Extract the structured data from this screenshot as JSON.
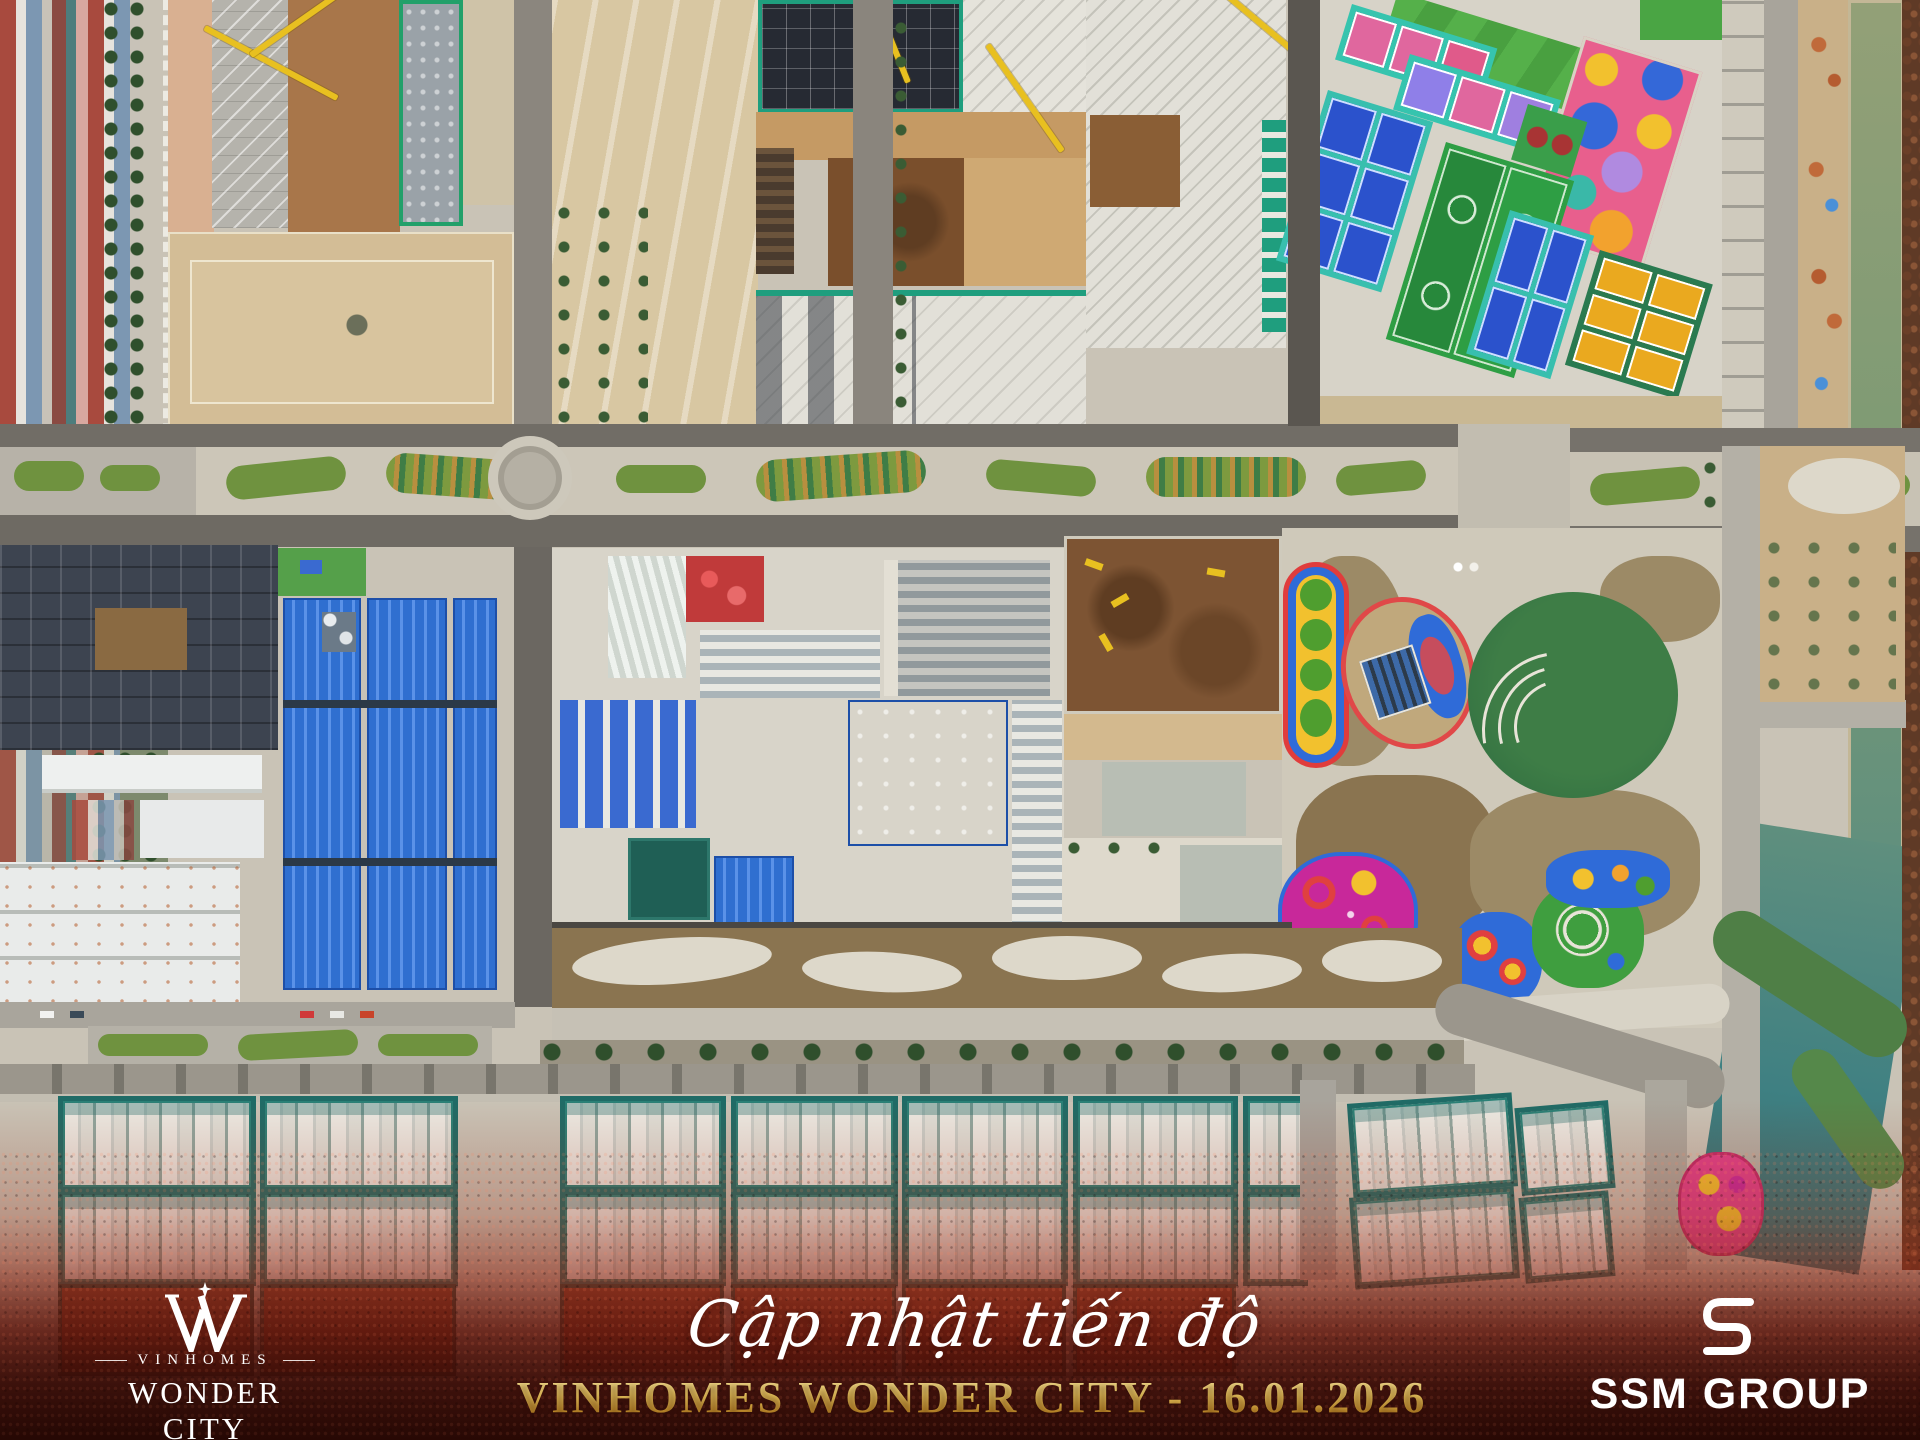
{
  "image": {
    "kind": "aerial drone photograph",
    "subject": "Vinhomes Wonder City construction progress update"
  },
  "caption": {
    "script": "Cập nhật tiến độ",
    "headline": "VINHOMES WONDER CITY - 16.01.2026",
    "date": "16.01.2026"
  },
  "logos": {
    "vinhomes": {
      "brand": "VINHOMES",
      "project": "WONDER CITY",
      "monogram_icon": "w-star-monogram-icon"
    },
    "ssm": {
      "name": "SSM GROUP",
      "icon": "ssm-s-icon"
    }
  },
  "colors": {
    "caption_gold": "#e8c35a",
    "caption_white": "#ffffff",
    "overlay_red": "#8a2a18",
    "overlay_red_dark": "#2e0a05",
    "court_blue": "#2b52cc",
    "court_teal": "#38bfae",
    "pitch_green": "#2e9e44",
    "court_yellow": "#eaa91f",
    "playground_pink": "#e0408a",
    "warehouse_blue": "#2f6fd0",
    "netting_teal": "#1f6b66",
    "canal_green": "#7d9a74",
    "canal_turquoise": "#3f8082"
  }
}
